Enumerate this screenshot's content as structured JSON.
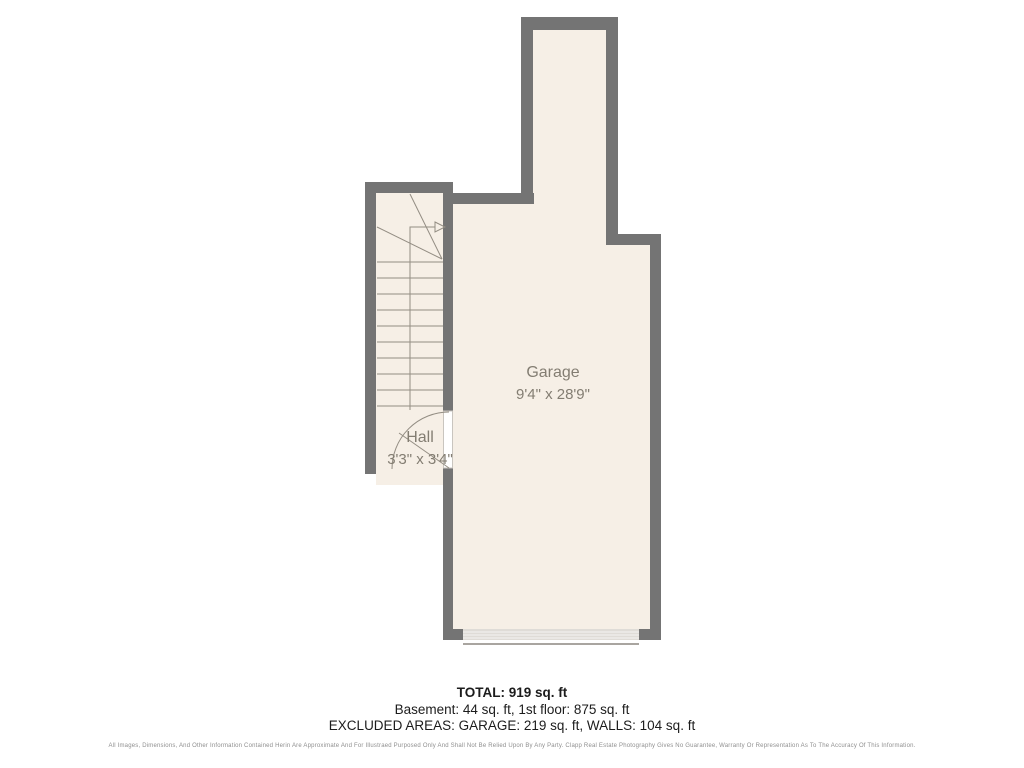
{
  "plan": {
    "labels": {
      "garage_name": "Garage",
      "garage_dims": "9'4\" x 28'9\"",
      "hall_name": "Hall",
      "hall_dims": "3'3\" x 3'4\""
    },
    "colors": {
      "wall": "#747474",
      "floor": "#F6EFE6",
      "line": "#938D83",
      "label": "#837D72",
      "garage_door_fill": "#DFDCD7",
      "garage_door_stripe": "#F6F5F3",
      "garage_door_track": "#A9A5A0",
      "door_recess_border": "#C9C5BF"
    }
  },
  "summary": {
    "total": "TOTAL: 919 sq. ft",
    "floors": "Basement: 44 sq. ft, 1st floor: 875 sq. ft",
    "excluded": "EXCLUDED AREAS: GARAGE: 219 sq. ft, WALLS: 104 sq. ft"
  },
  "disclaimer": "All Images, Dimensions, And Other Information Contained Herin Are Approximate And For Illustraed Purposed Only And Shall Not Be Relied Upon By Any Party. Clapp Real Estate Photography Gives No Guarantee, Warranty Or Representation As To The Accuracy Of This Information."
}
